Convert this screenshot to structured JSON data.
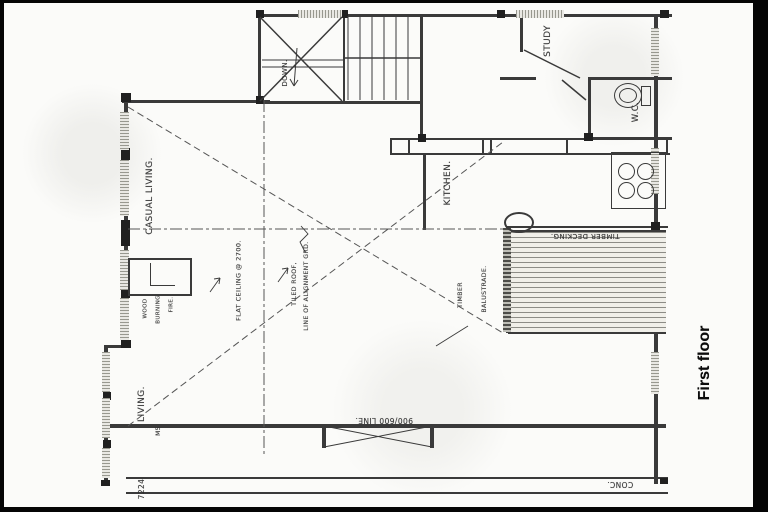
{
  "page_title": "First floor",
  "plan": {
    "floor_label": "First floor",
    "rooms": {
      "casual_living": "CASUAL LIVING.",
      "living": "LIVING.",
      "kitchen": "KITCHEN.",
      "study": "STUDY",
      "wc": "W.C.",
      "stairs_direction": "DOWN."
    },
    "annotations": {
      "flat_ceiling": "FLAT CEILING @ 2700.",
      "tiled_roof_line1": "TILED ROOF,",
      "tiled_roof_line2": "LINE OF ALIGNMENT GRD.",
      "fireplace_line1": "WOOD",
      "fireplace_line2": "BURNING",
      "fireplace_line3": "FIRE.",
      "balustrade_line1": "TIMBER",
      "balustrade_line2": "BALUSTRADE.",
      "decking": "TIMBER DECKING.",
      "door_opening": "900/600 LINE.",
      "concrete": "CONC.",
      "window_code": "M5"
    },
    "dimensions": {
      "left_edge": "7224"
    },
    "colors": {
      "ink": "#3a3a3a",
      "paper": "#fbfbf9",
      "scan_border": "#000000"
    }
  }
}
